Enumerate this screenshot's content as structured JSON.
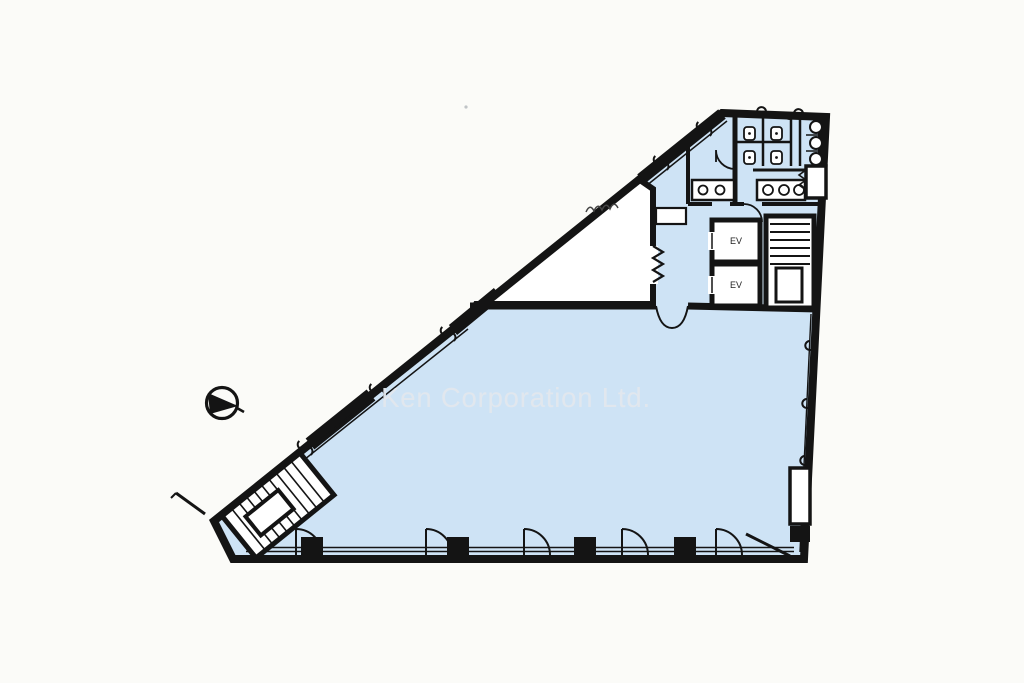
{
  "watermark": {
    "text": "Ken Corporation Ltd."
  },
  "core": {
    "elevators": [
      {
        "label": "EV"
      },
      {
        "label": "EV"
      }
    ]
  },
  "colors": {
    "floor": "#cee3f5",
    "wall": "#141414",
    "background": "#fbfbf8",
    "watermark": "#e3e8ee"
  },
  "icons": {
    "north_arrow": "north-arrow",
    "staircase": "stair-hatch",
    "door_swing": "door-swing-arc",
    "folding_door": "folding-door-zigzag",
    "toilet": "toilet-stall",
    "urinal": "urinal",
    "sink": "round-sink",
    "column": "structural-column",
    "window_break": "window-break-mark",
    "elevator": "elevator-shaft"
  }
}
